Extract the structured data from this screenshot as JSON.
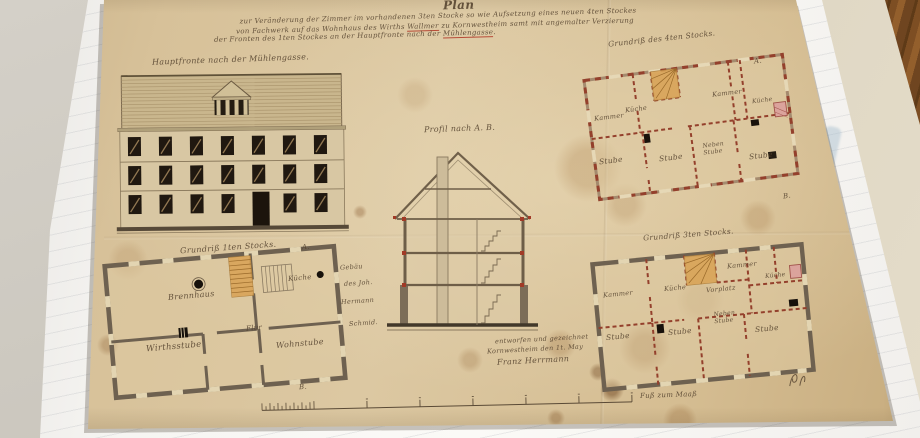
{
  "colors": {
    "paper": "#d6c099",
    "ink": "#54422e",
    "timber_red": "#94402c",
    "wall_gray": "#6e6150",
    "stair_wood": "#d8a355",
    "underline_red": "#b23a28",
    "wood_floor": "#7d4e23"
  },
  "title_block": {
    "heading": "Plan",
    "line1": "zur Veränderung der Zimmer im vorhandenen 3ten Stocke so wie Aufsetzung eines neuen 4ten Stockes",
    "line2_pre": "von Fachwerk auf das Wohnhaus des Wirths ",
    "line2_underlined": "Wallmer",
    "line2_post": " zu Kornwestheim samt mit angemalter Verzierung",
    "line3_pre": "der Fronten des 1ten Stockes an der Hauptfronte nach der ",
    "line3_underlined": "Mühlengasse",
    "line3_post": "."
  },
  "elevation": {
    "caption": "Hauptfronte nach der Mühlengasse."
  },
  "section": {
    "caption": "Profil nach A. B."
  },
  "plan_floor4": {
    "caption": "Grundriß des 4ten Stocks.",
    "marker_top": "A.",
    "marker_bottom": "B.",
    "rooms": {
      "kammer_left": "Kammer",
      "kueche_left": "Küche",
      "kammer_right": "Kammer",
      "kueche_right": "Küche",
      "stube_1": "Stube",
      "stube_2": "Stube",
      "neben_stube": "Neben Stube",
      "stube_3": "Stube"
    }
  },
  "plan_floor3": {
    "caption": "Grundriß 3ten Stocks.",
    "rooms": {
      "kammer_left": "Kammer",
      "kueche_left": "Küche",
      "vorplatz": "Vorplatz",
      "kammer_top": "Kammer",
      "kueche_right": "Küche",
      "stube_1": "Stube",
      "stube_2": "Stube",
      "neben_stube": "Neben Stube",
      "stube_3": "Stube"
    }
  },
  "plan_floor1": {
    "caption": "Grundriß 1ten Stocks.",
    "marker_top": "A.",
    "marker_bottom": "B.",
    "rooms": {
      "brennhaus": "Brennhaus",
      "kueche": "Küche",
      "flur": "Flur",
      "wirthsstube": "Wirthsstube",
      "wohnstube": "Wohnstube"
    },
    "margin_note": {
      "line1": "Gebäu",
      "line2": "des Joh.",
      "line3": "Hermann",
      "line4": "Schmid."
    }
  },
  "scale_bar": {
    "label": "Fuß zum Maaß"
  },
  "signature": {
    "line1": "entworfen und gezeichnet",
    "line2": "Kornwestheim den 1t. May",
    "line3": "Franz Herrmann"
  }
}
